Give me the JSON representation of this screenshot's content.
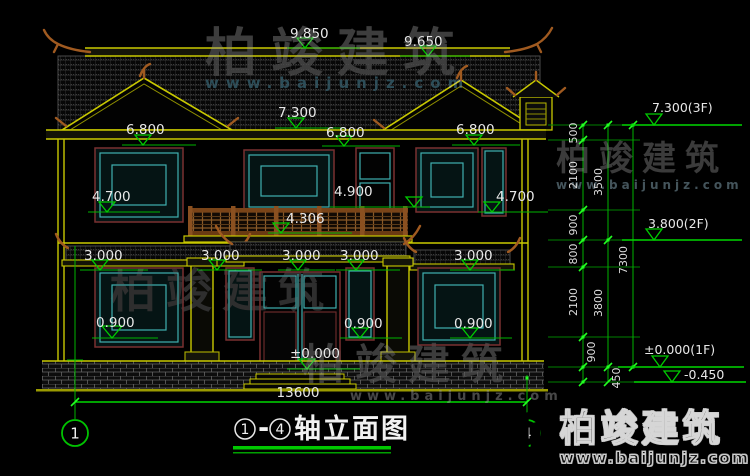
{
  "watermark": {
    "brand": "柏竣建筑",
    "url": "www.baijunjz.com"
  },
  "title": {
    "axis_from": "1",
    "dash": "-",
    "axis_to": "4",
    "text": "轴立面图"
  },
  "axis_markers": {
    "left": "1",
    "right": "4"
  },
  "dimensions": {
    "ridge_left": "9.850",
    "ridge_right": "9.650",
    "eave_2f": "7.300",
    "lintel_2f_left": "6.800",
    "lintel_2f_mid": "6.800",
    "lintel_2f_right": "6.800",
    "sill_2f_left": "4.700",
    "sill_2f_right": "4.700",
    "rail_top": "4.900",
    "rail_base": "4.306",
    "lintel_1f_1": "3.000",
    "lintel_1f_2": "3.000",
    "lintel_1f_3": "3.000",
    "lintel_1f_4": "3.000",
    "lintel_1f_5": "3.000",
    "sill_1f_left": "0.900",
    "sill_1f_mid": "0.900",
    "sill_1f_right": "0.900",
    "floor_1f": "±0.000",
    "overall_width": "13600"
  },
  "levels": {
    "f3": "7.300(3F)",
    "f2": "3.800(2F)",
    "f1": "±0.000(1F)",
    "ground": "-0.450"
  },
  "chain": {
    "seg_500": "500",
    "seg_2100_top": "2100",
    "seg_900_top": "900",
    "seg_800": "800",
    "seg_2100_bot": "2100",
    "seg_900_bot": "900",
    "seg_450": "450",
    "sum_3500": "3500",
    "sum_3800": "3800",
    "total_7300": "7300"
  }
}
